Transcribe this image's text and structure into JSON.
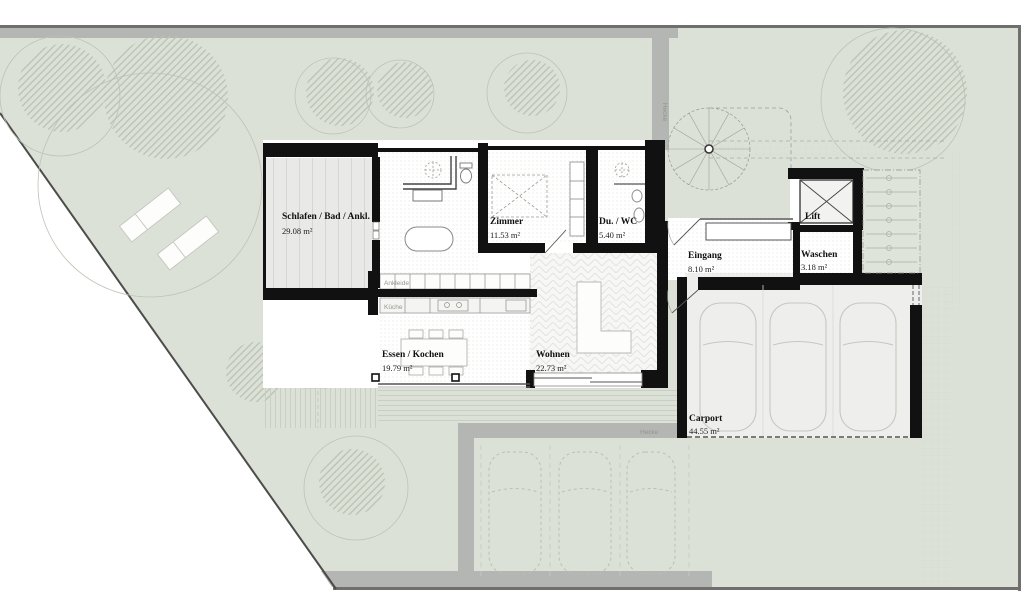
{
  "site": {
    "hedge_label_vertical": "Hecke",
    "hedge_label_horizontal": "Hecke"
  },
  "rooms": {
    "schlafen": {
      "name": "Schlafen / Bad / Ankl.",
      "area": "29.08 m²"
    },
    "zimmer": {
      "name": "Zimmer",
      "area": "11.53 m²"
    },
    "du_wc": {
      "name": "Du. / WC",
      "area": "5.40 m²"
    },
    "lift": {
      "name": "Lift"
    },
    "eingang": {
      "name": "Eingang",
      "area": "8.10 m²"
    },
    "waschen": {
      "name": "Waschen",
      "area": "3.18 m²"
    },
    "essen_kochen": {
      "name": "Essen / Kochen",
      "area": "19.79 m²"
    },
    "wohnen": {
      "name": "Wohnen",
      "area": "22.73 m²"
    },
    "carport": {
      "name": "Carport",
      "area": "44.55 m²"
    }
  },
  "fixtures": {
    "ankleide": "Ankleide",
    "kueche": "Küche"
  },
  "colors": {
    "site_green": "#dce1d8",
    "path_gray": "#b3b6b2",
    "wall_black": "#111111",
    "border_dark": "#6f6f6d",
    "carport_floor": "#eeeeec"
  }
}
